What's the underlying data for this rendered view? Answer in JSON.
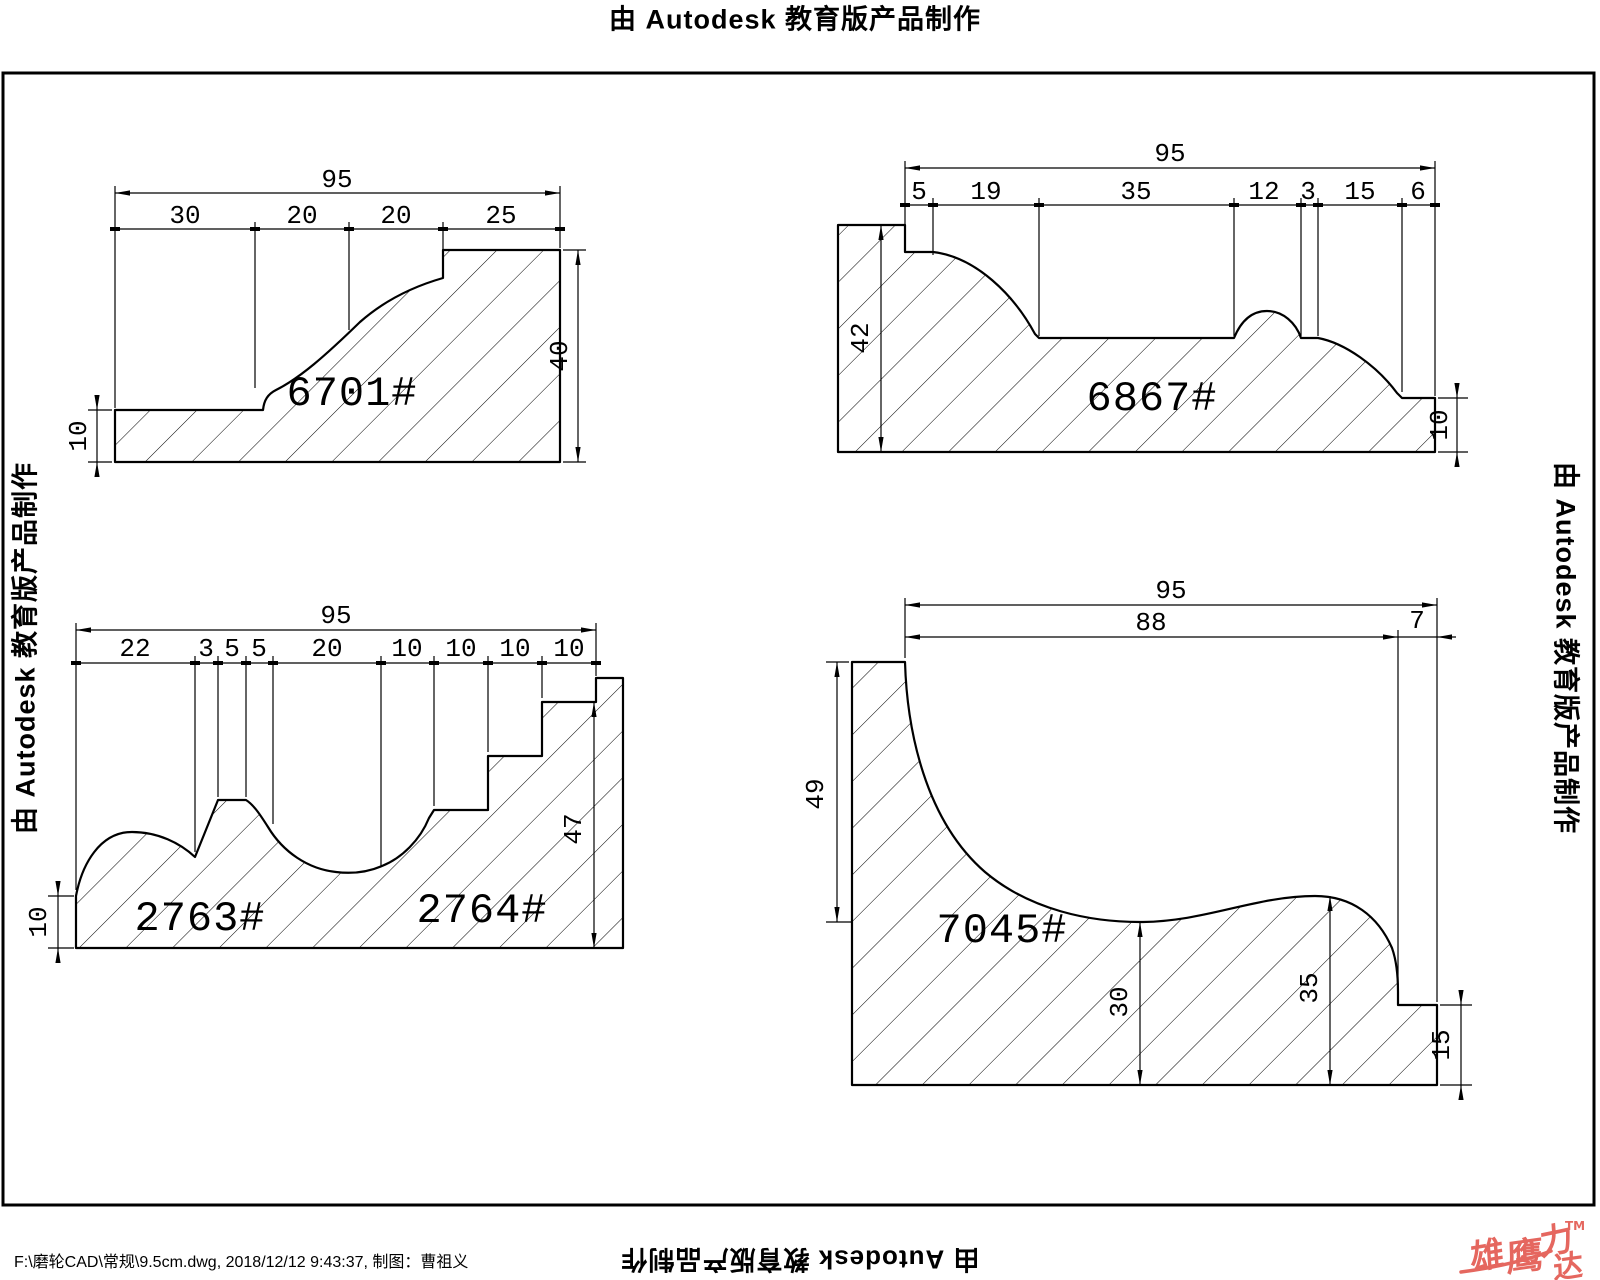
{
  "canvas": {
    "width": 1600,
    "height": 1280,
    "background": "#ffffff",
    "line_color": "#000000"
  },
  "watermark": {
    "stamp_text": "由 Autodesk 教育版产品制作"
  },
  "footer": {
    "file_info": "F:\\磨轮CAD\\常规\\9.5cm.dwg, 2018/12/12 9:43:37, 制图：曹祖义"
  },
  "logo": {
    "char1": "雄",
    "char2": "鹰",
    "char3": "力",
    "char4": "达",
    "tm": "TM",
    "color": "#e5675f"
  },
  "drawings": [
    {
      "part_no": "6701#",
      "dim_overall": "95",
      "segments": [
        "30",
        "20",
        "20",
        "25"
      ],
      "dim_height": "40",
      "dim_base": "10"
    },
    {
      "part_no": "6867#",
      "dim_overall": "95",
      "segments": [
        "5",
        "19",
        "35",
        "12",
        "3",
        "15",
        "6"
      ],
      "dim_height": "42",
      "dim_right": "10"
    },
    {
      "part_no_left": "2763#",
      "part_no_right": "2764#",
      "dim_overall": "95",
      "segments": [
        "22",
        "3",
        "5",
        "5",
        "20",
        "10",
        "10",
        "10",
        "10"
      ],
      "dim_height": "47",
      "dim_base": "10"
    },
    {
      "part_no": "7045#",
      "dim_overall": "95",
      "dim_width2": "88",
      "dim_step": "7",
      "dim_height": "49",
      "dim_valley": "30",
      "dim_crest": "35",
      "dim_right": "15"
    }
  ]
}
